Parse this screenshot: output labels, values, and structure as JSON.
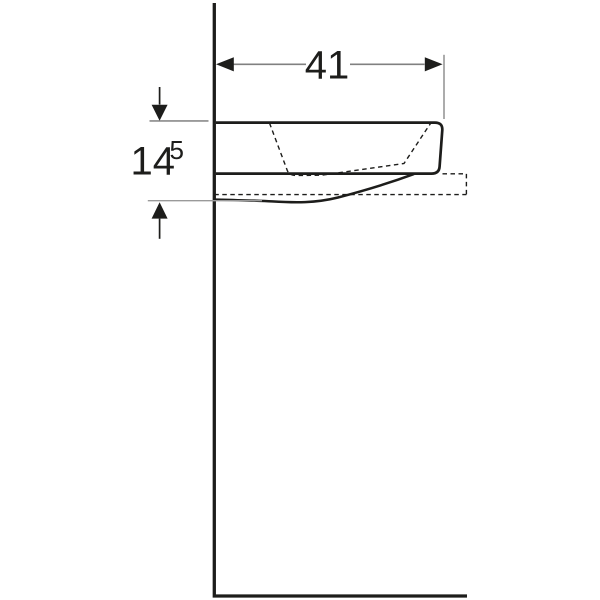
{
  "drawing": {
    "dimensions": {
      "width": {
        "value": "41"
      },
      "height": {
        "value": "14",
        "superscript": "5"
      }
    },
    "colors": {
      "outline": "#1d1d1b",
      "dimension_line": "#808080",
      "background": "#ffffff"
    }
  }
}
